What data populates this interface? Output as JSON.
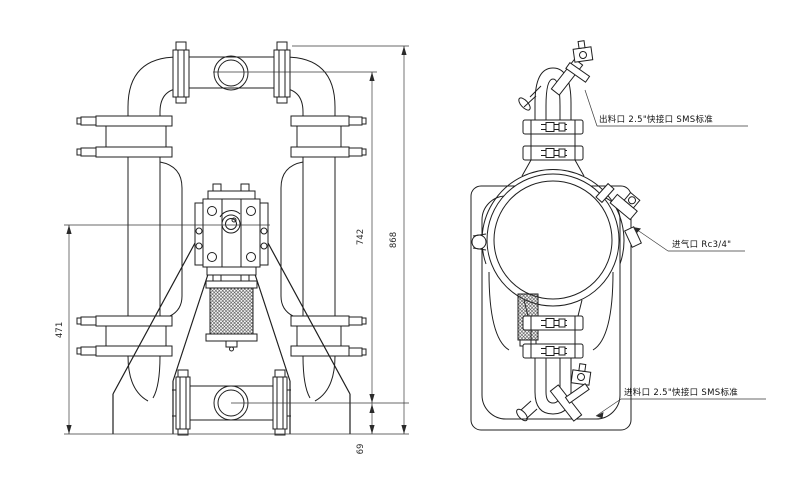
{
  "drawing": {
    "type": "engineering-dimension-drawing",
    "views": [
      "front",
      "side"
    ],
    "colors": {
      "line": "#1f1f1f",
      "dim_line": "#3a3a3a",
      "background": "#ffffff"
    },
    "dimensions": {
      "outlet_port_center_height": "742",
      "overall_height": "868",
      "air_valve_center_height": "471",
      "inlet_port_center_height": "69"
    },
    "ports": {
      "outlet_label": "出料口 2.5\"快接口 SMS标准",
      "air_inlet_label": "进气口 Rc3/4\"",
      "inlet_label": "进料口 2.5\"快接口 SMS标准"
    }
  }
}
